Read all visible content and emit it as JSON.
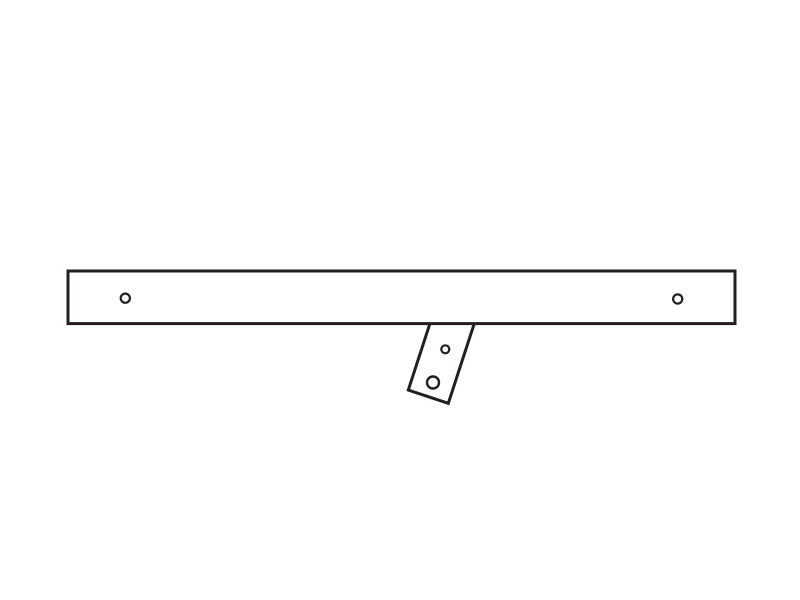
{
  "canvas": {
    "width": 800,
    "height": 600,
    "view_box": "0 0 800 600",
    "background": "#ffffff"
  },
  "drawing": {
    "description": "line-art diagram of a flat bar part with end holes and an angled mounting tab",
    "stroke_color": "#231f20",
    "fill_color": "#ffffff",
    "bar": {
      "x": 68,
      "y": 271,
      "width": 667,
      "height": 52.6,
      "stroke_width": 3,
      "holes": [
        {
          "name": "left-end-hole",
          "cx": 125.3,
          "cy": 298.2,
          "r": 4.6,
          "stroke_width": 2.2
        },
        {
          "name": "right-end-hole",
          "cx": 677.7,
          "cy": 299.0,
          "r": 4.6,
          "stroke_width": 2.2
        }
      ]
    },
    "tab": {
      "points": "437.7,299.7 477.7,313.0 448.3,403.3 408.3,390.0",
      "stroke_width": 3,
      "rotation_deg": 18,
      "holes": [
        {
          "name": "tab-upper-hole",
          "cx": 445.3,
          "cy": 349.3,
          "r": 4.0,
          "stroke_width": 2.2
        },
        {
          "name": "tab-lower-hole",
          "cx": 433.0,
          "cy": 382.5,
          "r": 6.0,
          "stroke_width": 2.4
        }
      ]
    }
  }
}
